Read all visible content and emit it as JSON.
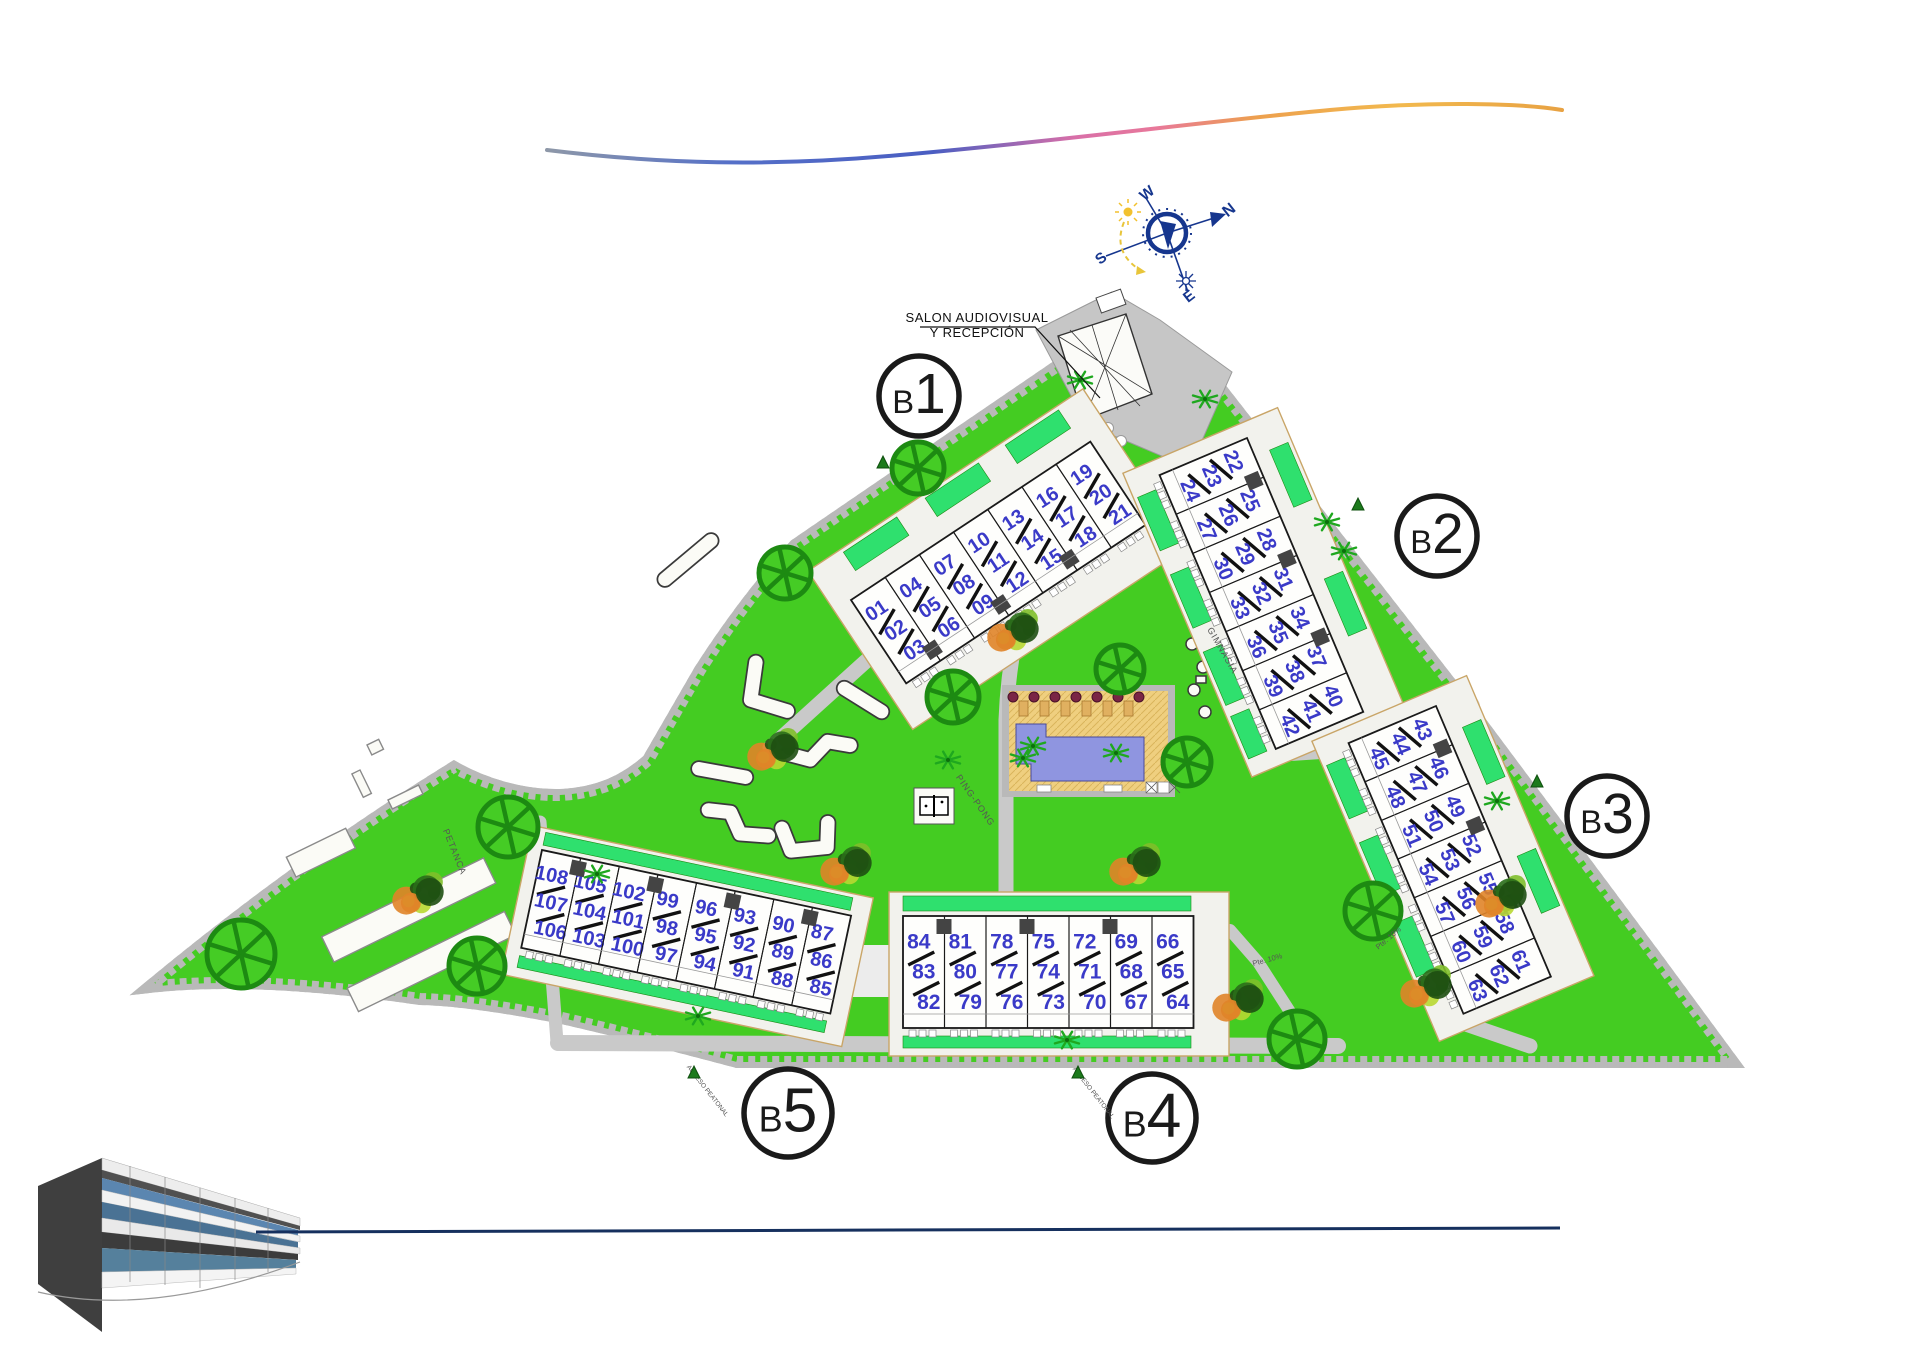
{
  "plan": {
    "compass": {
      "n": "N",
      "e": "E",
      "s": "S",
      "w": "W"
    },
    "reception_label": {
      "line1": "SALON AUDIOVISUAL",
      "line2": "Y RECEPCIÓN"
    },
    "areas": {
      "petanca": "PETANCA",
      "gym": "GIMNASIA",
      "ping_pong": "PING-PONG"
    },
    "road_labels": [
      {
        "text": "Pte. 10%"
      },
      {
        "text": "Pte. 10%"
      },
      {
        "text": "ACCESO PEATONAL"
      },
      {
        "text": "ACCESO PEATONAL"
      }
    ],
    "blocks": [
      {
        "id": "B1",
        "badge_prefix": "B",
        "badge_number": "1",
        "units": [
          [
            "01",
            "02",
            "03"
          ],
          [
            "04",
            "05",
            "06"
          ],
          [
            "07",
            "08",
            "09"
          ],
          [
            "10",
            "11",
            "12"
          ],
          [
            "13",
            "14",
            "15"
          ],
          [
            "16",
            "17",
            "18"
          ],
          [
            "19",
            "20",
            "21"
          ]
        ]
      },
      {
        "id": "B2",
        "badge_prefix": "B",
        "badge_number": "2",
        "units": [
          [
            "22",
            "23",
            "24"
          ],
          [
            "25",
            "26",
            "27"
          ],
          [
            "28",
            "29",
            "30"
          ],
          [
            "31",
            "32",
            "33"
          ],
          [
            "34",
            "35",
            "36"
          ],
          [
            "37",
            "38",
            "39"
          ],
          [
            "40",
            "41",
            "42"
          ]
        ]
      },
      {
        "id": "B3",
        "badge_prefix": "B",
        "badge_number": "3",
        "units": [
          [
            "43",
            "44",
            "45"
          ],
          [
            "46",
            "47",
            "48"
          ],
          [
            "49",
            "50",
            "51"
          ],
          [
            "52",
            "53",
            "54"
          ],
          [
            "55",
            "56",
            "57"
          ],
          [
            "58",
            "59",
            "60"
          ],
          [
            "61",
            "62",
            "63"
          ]
        ]
      },
      {
        "id": "B4",
        "badge_prefix": "B",
        "badge_number": "4",
        "units": [
          [
            "84",
            "83",
            "82"
          ],
          [
            "81",
            "80",
            "79"
          ],
          [
            "78",
            "77",
            "76"
          ],
          [
            "75",
            "74",
            "73"
          ],
          [
            "72",
            "71",
            "70"
          ],
          [
            "69",
            "68",
            "67"
          ],
          [
            "66",
            "65",
            "64"
          ]
        ]
      },
      {
        "id": "B5",
        "badge_prefix": "B",
        "badge_number": "5",
        "units": [
          [
            "108",
            "107",
            "106"
          ],
          [
            "105",
            "104",
            "103"
          ],
          [
            "102",
            "101",
            "100"
          ],
          [
            "99",
            "98",
            "97"
          ],
          [
            "96",
            "95",
            "94"
          ],
          [
            "93",
            "92",
            "91"
          ],
          [
            "90",
            "89",
            "88"
          ],
          [
            "87",
            "86",
            "85"
          ]
        ]
      }
    ],
    "colors": {
      "lawn": "#44CC22",
      "parking": "#2FE06E",
      "boundary": "#A64CC8",
      "road": "#C9C9C9",
      "unit_number": "#3A3AC8",
      "pool_water": "#8F95E0",
      "pool_deck": "#EFCF7F",
      "tree": "#1D8A12",
      "accent_blue": "#16368E"
    }
  }
}
